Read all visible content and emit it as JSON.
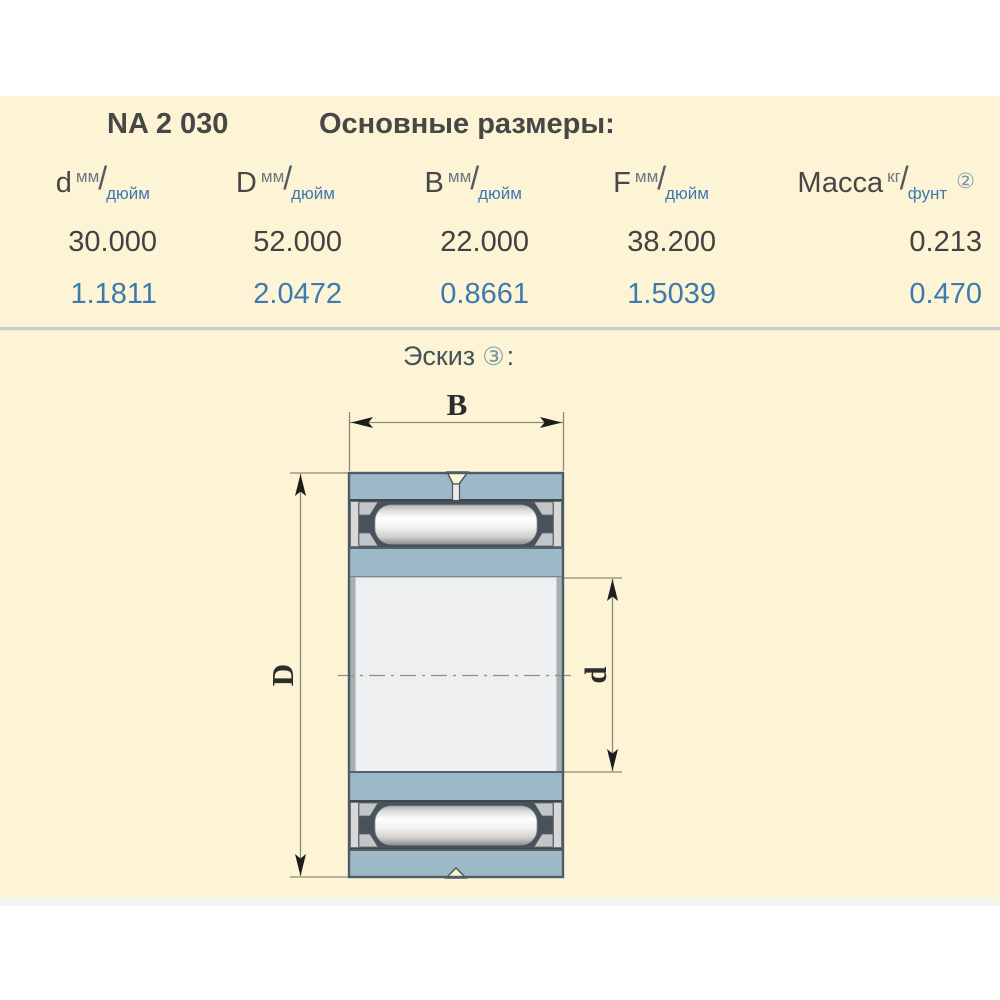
{
  "title": {
    "part_number": "NA 2 030",
    "section": "Основные размеры:"
  },
  "table": {
    "slash": "/",
    "columns": [
      {
        "symbol": "d",
        "unit_top": "мм",
        "unit_bottom": "дюйм",
        "note": ""
      },
      {
        "symbol": "D",
        "unit_top": "мм",
        "unit_bottom": "дюйм",
        "note": ""
      },
      {
        "symbol": "B",
        "unit_top": "мм",
        "unit_bottom": "дюйм",
        "note": ""
      },
      {
        "symbol": "F",
        "unit_top": "мм",
        "unit_bottom": "дюйм",
        "note": ""
      },
      {
        "symbol": "Масса",
        "unit_top": "кг",
        "unit_bottom": "фунт",
        "note": "②"
      }
    ],
    "row_mm": [
      "30.000",
      "52.000",
      "22.000",
      "38.200",
      "0.213"
    ],
    "row_inch": [
      "1.1811",
      "2.0472",
      "0.8661",
      "1.5039",
      "0.470"
    ]
  },
  "sketch": {
    "label": "Эскиз",
    "note": "③",
    "colon": ":",
    "dim_width": "B",
    "dim_outer_diameter": "D",
    "dim_bore_diameter": "d"
  },
  "colors": {
    "page_background": "#ffffff",
    "panel_background": "#fcf4d5",
    "text_dark": "#474747",
    "text_blue": "#3d7ab1",
    "note_mark": "#7e97a7",
    "ring_blue": "#9db8c7",
    "ring_outline": "#53626b",
    "roller_cage_dark": "#47525a",
    "bore_fill": "#edeff0",
    "dim_line": "#8b8b7b"
  }
}
